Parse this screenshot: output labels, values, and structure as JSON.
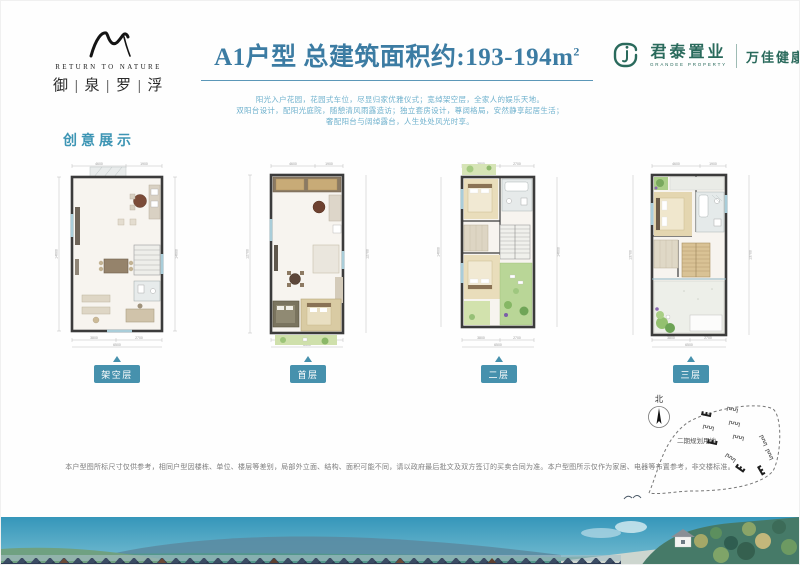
{
  "header": {
    "brand": {
      "name_en": "RETURN TO NATURE",
      "name_cn": "御 | 泉 | 罗 | 浮"
    },
    "title": {
      "main": "A1户型 总建筑面积约:193-194m",
      "sup": "2"
    },
    "developer": {
      "name_cn": "君泰置业",
      "name_en": "GRANDEE PROPERTY",
      "partner": "万佳健康"
    }
  },
  "intro": {
    "lines": [
      "阳光入户花园，花园式车位，尽显归家优雅仪式；宽绰架空层，全家人的娱乐天地。",
      "双阳台设计，配阳光庭院，随憩清风雨露造访；独立套房设计，尊阔格局，安然静享起居生活；",
      "奢配阳台与阔绰露台，人生处处风光时享。"
    ]
  },
  "section_label": "创意展示",
  "plans": [
    {
      "label": "架空层",
      "dims": {
        "top0": "4600",
        "top1": "1900",
        "left": "14600",
        "right": "14600",
        "bot0": "3800",
        "bot1": "2700",
        "total": "6500"
      }
    },
    {
      "label": "首层",
      "dims": {
        "top0": "4600",
        "top1": "1900",
        "left": "12700",
        "right": "12700",
        "bot0": "3200",
        "bot1": "2300",
        "total": "6500"
      }
    },
    {
      "label": "二层",
      "dims": {
        "top0": "3800",
        "top1": "2700",
        "left": "14600",
        "right": "14600",
        "bot0": "3800",
        "bot1": "2700",
        "total": "6500"
      }
    },
    {
      "label": "三层",
      "dims": {
        "top0": "4600",
        "top1": "1900",
        "left": "13700",
        "right": "13700",
        "bot0": "3800",
        "bot1": "2700",
        "total": "6500"
      }
    }
  ],
  "siteplan": {
    "compass_label": "北",
    "area_label": "二期规划用地"
  },
  "disclaimer": "本户型图所标尺寸仅供参考，相同户型因楼栋、单位、楼层等差别，局部外立面、结构、面积可能不同，请以政府最后批文及双方签订的买卖合同为准。本户型图所示仅作为家居、电器等布置参考，非交楼标准。",
  "colors": {
    "accent_blue": "#3c7ca3",
    "intro_blue": "#6fb1cd",
    "label_teal": "#4691ad",
    "brand_green": "#2a6a5c"
  }
}
